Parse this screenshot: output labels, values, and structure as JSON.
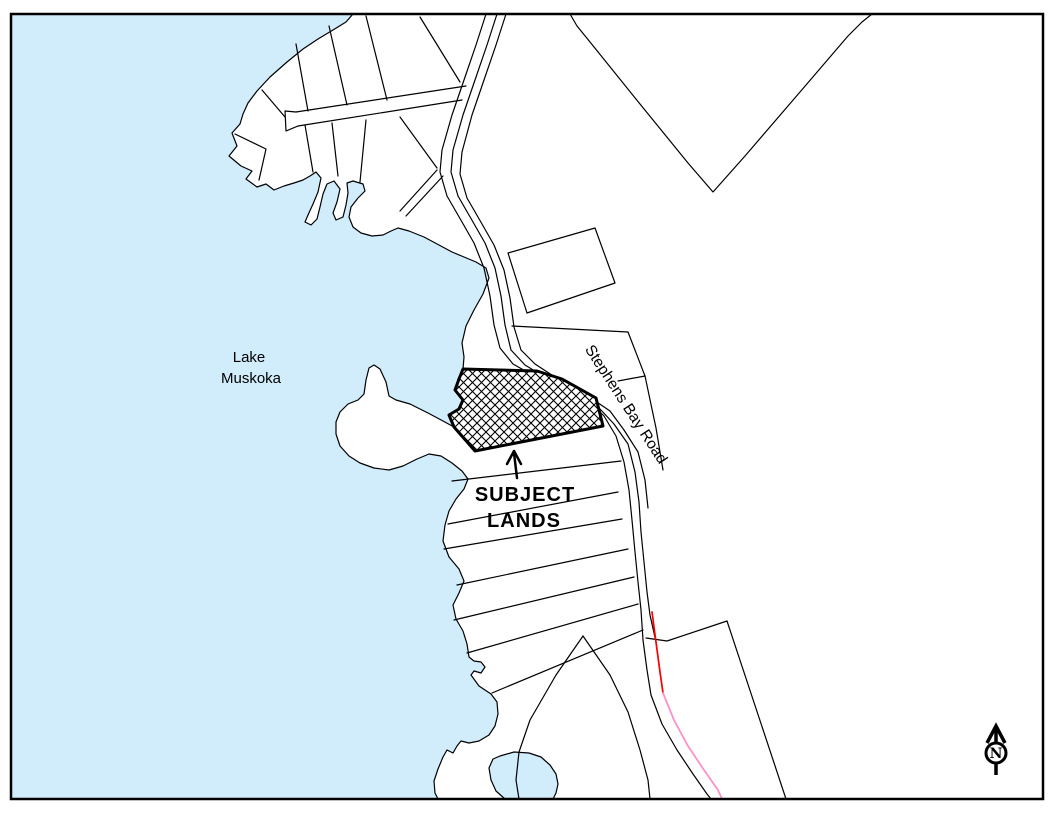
{
  "map": {
    "labels": {
      "lake": {
        "line1": "Lake",
        "line2": "Muskoka"
      },
      "road": "Stephens Bay Road",
      "subject": {
        "line1": "SUBJECT",
        "line2": "LANDS"
      },
      "north": "N"
    },
    "colors": {
      "water": "#D1ECFB",
      "outline": "#000000",
      "road_highlight_red": "#FF0000",
      "road_highlight_pink": "#FF8FCB",
      "land": "#FFFFFF"
    }
  }
}
